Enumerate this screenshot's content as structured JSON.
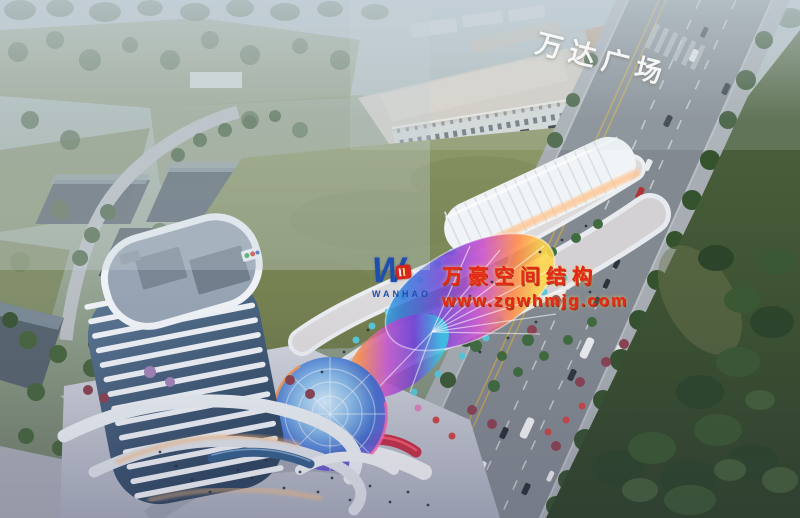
{
  "image": {
    "type": "aerial architectural rendering of a mixed-use commercial complex at dusk",
    "landmarks": [
      "office tower",
      "rainbow canopy dome",
      "barrel-roof retail hall",
      "Wanda Plaza mall",
      "central green field",
      "tree-lined avenue"
    ]
  },
  "signs": {
    "mall_roof_sign": "万达广场"
  },
  "watermark": {
    "logo_monogram": "W",
    "logo_text": "WANHAO",
    "company": "万豪空间结构",
    "website": "www.zgwhmjg.com"
  },
  "colors": {
    "watermark_red": "#e42718",
    "logo_blue": "#1e4fae",
    "mall_sign_white": "#fafcfd",
    "field_green": "#7e8a56",
    "lawn_green": "#35502c",
    "road_grey": "#828990",
    "tower_band_white": "#eef2f6",
    "tower_glass_blue": "#48627f",
    "canopy_rainbow": [
      "#35d0e8",
      "#3a7de0",
      "#7a44d8",
      "#c84fd0",
      "#ff8a4a",
      "#ffd84a"
    ]
  }
}
